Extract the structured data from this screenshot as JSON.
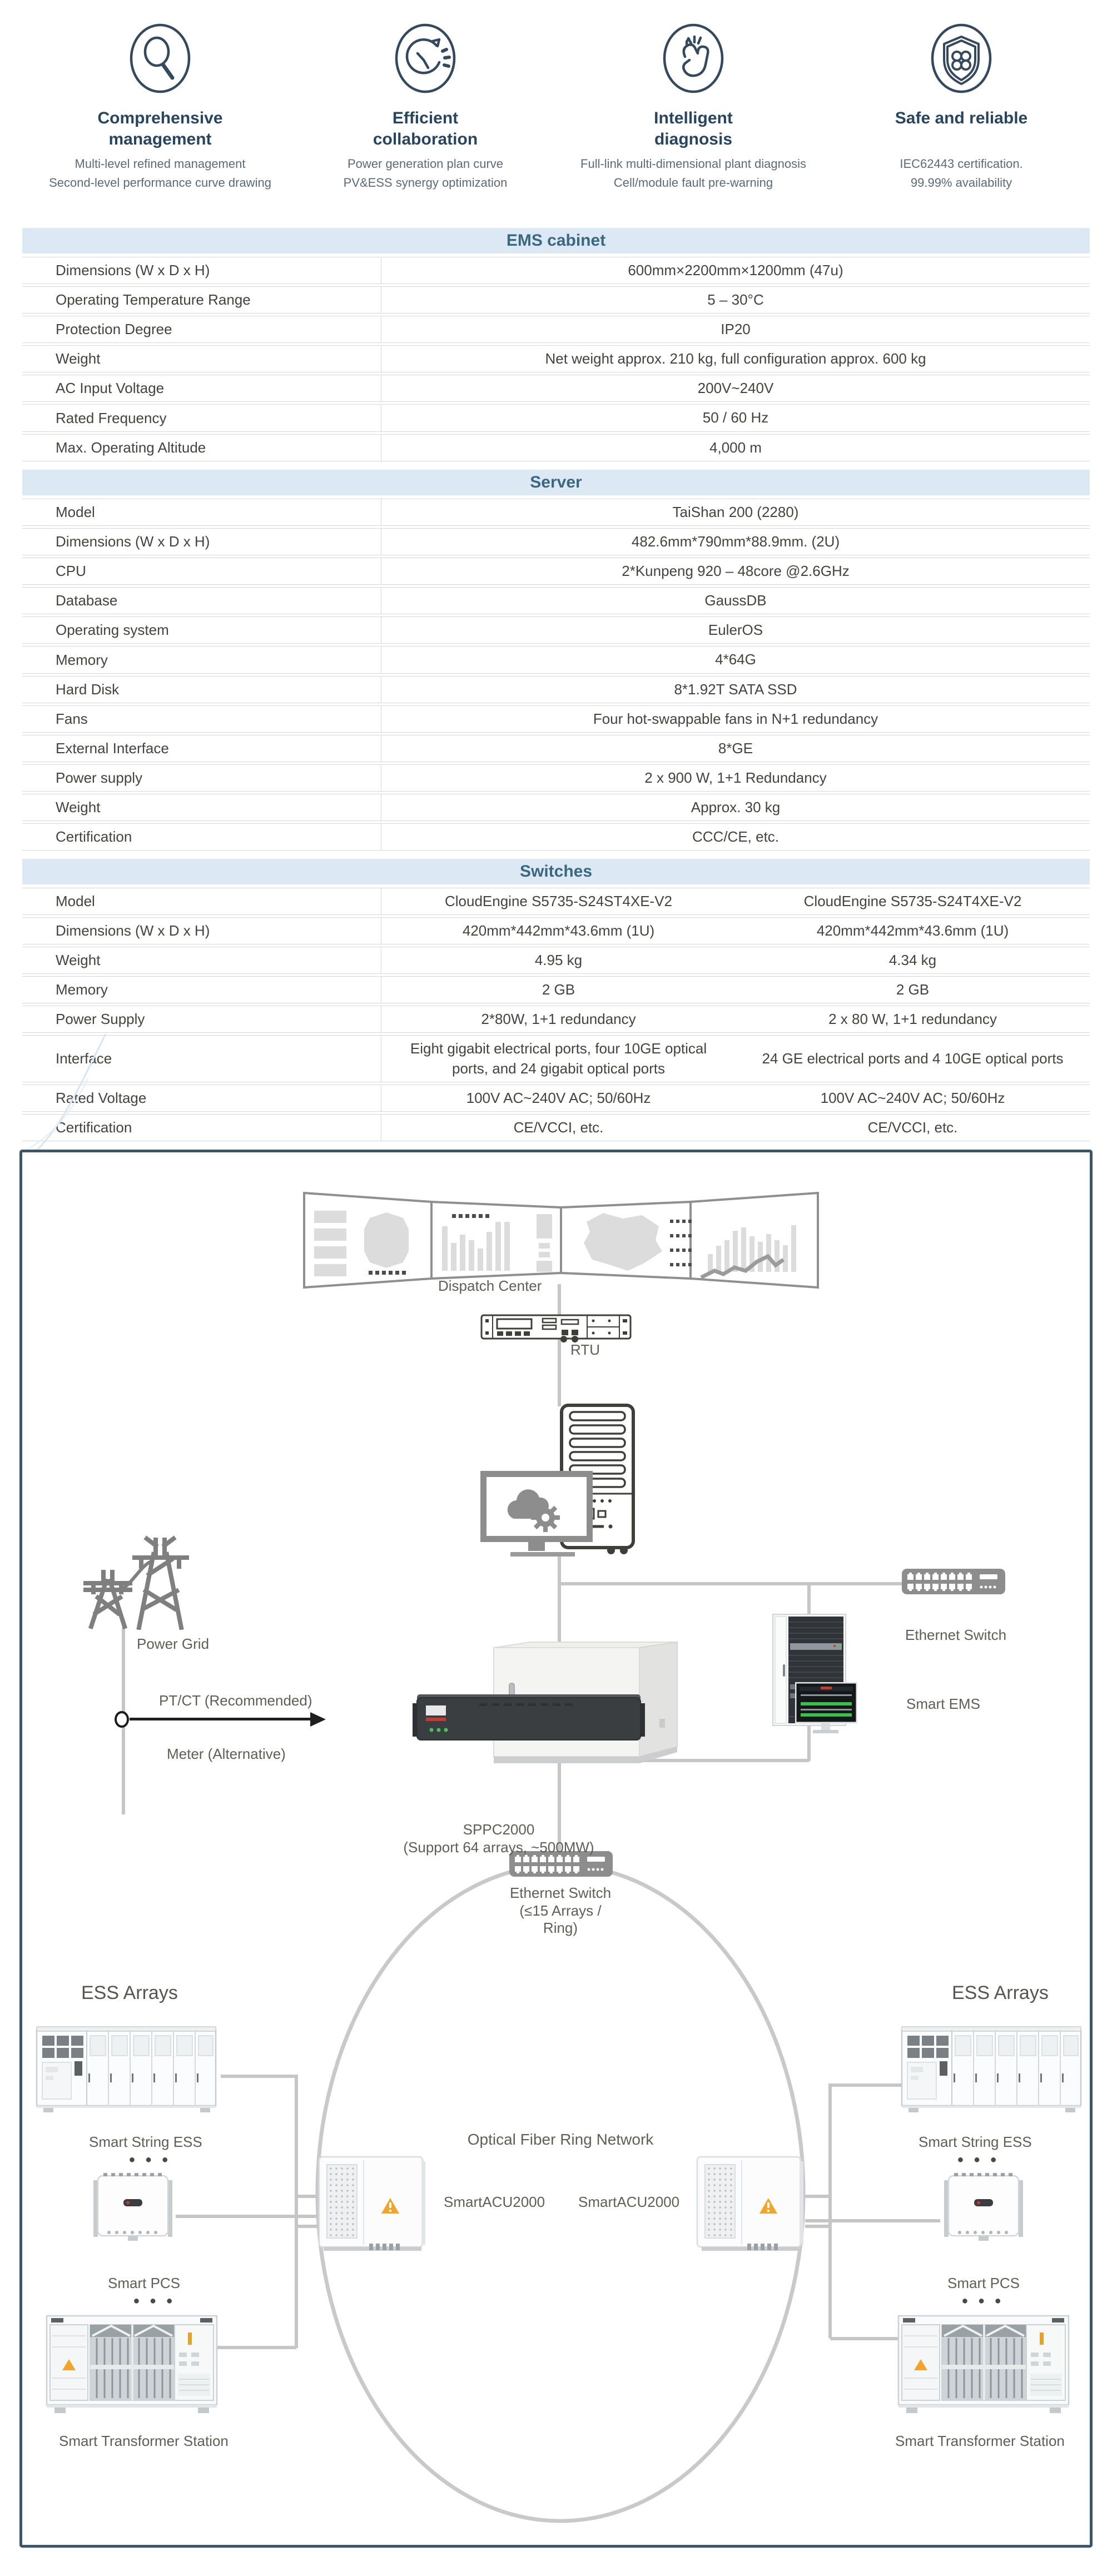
{
  "features": [
    {
      "icon": "magnifier-icon",
      "title": "Comprehensive management",
      "line1": "Multi-level refined management",
      "line2": "Second-level performance curve drawing"
    },
    {
      "icon": "clock-cycle-icon",
      "title": "Efficient collaboration",
      "line1": "Power generation plan curve",
      "line2": "PV&ESS  synergy optimization"
    },
    {
      "icon": "finger-snap-icon",
      "title": "Intelligent diagnosis",
      "line1": "Full-link multi-dimensional plant diagnosis",
      "line2": "Cell/module fault pre-warning"
    },
    {
      "icon": "shield-clover-icon",
      "title": "Safe and reliable",
      "line1": "IEC62443 certification.",
      "line2": "99.99% availability"
    }
  ],
  "tables": [
    {
      "title": "EMS cabinet",
      "rows": [
        [
          "Dimensions (W x D x H)",
          "600mm×2200mm×1200mm (47u)"
        ],
        [
          "Operating Temperature Range",
          "5 – 30°C"
        ],
        [
          "Protection Degree",
          "IP20"
        ],
        [
          "Weight",
          "Net weight approx. 210 kg, full configuration approx. 600 kg"
        ],
        [
          "AC Input Voltage",
          "200V~240V"
        ],
        [
          "Rated Frequency",
          "50 / 60 Hz"
        ],
        [
          "Max. Operating Altitude",
          "4,000 m"
        ]
      ]
    },
    {
      "title": "Server",
      "rows": [
        [
          "Model",
          "TaiShan 200 (2280)"
        ],
        [
          "Dimensions (W x D x H)",
          "482.6mm*790mm*88.9mm. (2U)"
        ],
        [
          "CPU",
          "2*Kunpeng 920 – 48core @2.6GHz"
        ],
        [
          "Database",
          "GaussDB"
        ],
        [
          "Operating system",
          "EulerOS"
        ],
        [
          "Memory",
          "4*64G"
        ],
        [
          "Hard Disk",
          "8*1.92T SATA SSD"
        ],
        [
          "Fans",
          "Four hot-swappable fans in N+1 redundancy"
        ],
        [
          "External Interface",
          "8*GE"
        ],
        [
          "Power supply",
          "2 x 900 W, 1+1 Redundancy"
        ],
        [
          "Weight",
          "Approx. 30 kg"
        ],
        [
          "Certification",
          "CCC/CE, etc."
        ]
      ]
    },
    {
      "title": "Switches",
      "rows": [
        [
          "Model",
          "CloudEngine S5735-S24ST4XE-V2",
          "CloudEngine S5735-S24T4XE-V2"
        ],
        [
          "Dimensions (W x D x H)",
          "420mm*442mm*43.6mm (1U)",
          "420mm*442mm*43.6mm (1U)"
        ],
        [
          "Weight",
          "4.95 kg",
          "4.34 kg"
        ],
        [
          "Memory",
          "2 GB",
          "2 GB"
        ],
        [
          "Power Supply",
          "2*80W, 1+1 redundancy",
          "2 x 80 W, 1+1 redundancy"
        ],
        [
          "Interface",
          "Eight gigabit electrical ports, four 10GE optical ports, and 24 gigabit optical ports",
          "24 GE electrical ports and 4 10GE optical ports"
        ],
        [
          "Rated Voltage",
          "100V AC~240V AC; 50/60Hz",
          "100V AC~240V AC; 50/60Hz"
        ],
        [
          "Certification",
          "CE/VCCI, etc.",
          "CE/VCCI, etc."
        ]
      ]
    }
  ],
  "diagram": {
    "dispatch_center": "Dispatch Center",
    "rtu": "RTU",
    "power_grid": "Power Grid",
    "ptct": "PT/CT (Recommended)",
    "meter": "Meter (Alternative)",
    "sppc_line1": "SPPC2000",
    "sppc_line2": "(Support 64 arrays, ~500MW)",
    "ethernet_switch": "Ethernet Switch",
    "smart_ems": "Smart EMS",
    "ring_switch_line1": "Ethernet Switch",
    "ring_switch_line2": "(≤15 Arrays /",
    "ring_switch_line3": "Ring)",
    "ring_title": "Optical Fiber Ring Network",
    "acu_left": "SmartACU2000",
    "acu_right": "SmartACU2000",
    "ess_arrays_left": "ESS Arrays",
    "ess_arrays_right": "ESS Arrays",
    "string_ess_left": "Smart String ESS",
    "string_ess_right": "Smart String ESS",
    "pcs_left": "Smart PCS",
    "pcs_right": "Smart PCS",
    "transformer_left": "Smart Transformer Station",
    "transformer_right": "Smart Transformer Station",
    "dots": "● ● ●"
  },
  "colors": {
    "header_bg": "#dce9f5",
    "header_text": "#3a6880",
    "table_text": "#44433c",
    "diagram_border": "#3b5668",
    "line_gray": "#c6c6c6",
    "label_gray": "#5e5f55",
    "icon_navy": "#35495e",
    "warning_orange": "#f0a82a"
  }
}
